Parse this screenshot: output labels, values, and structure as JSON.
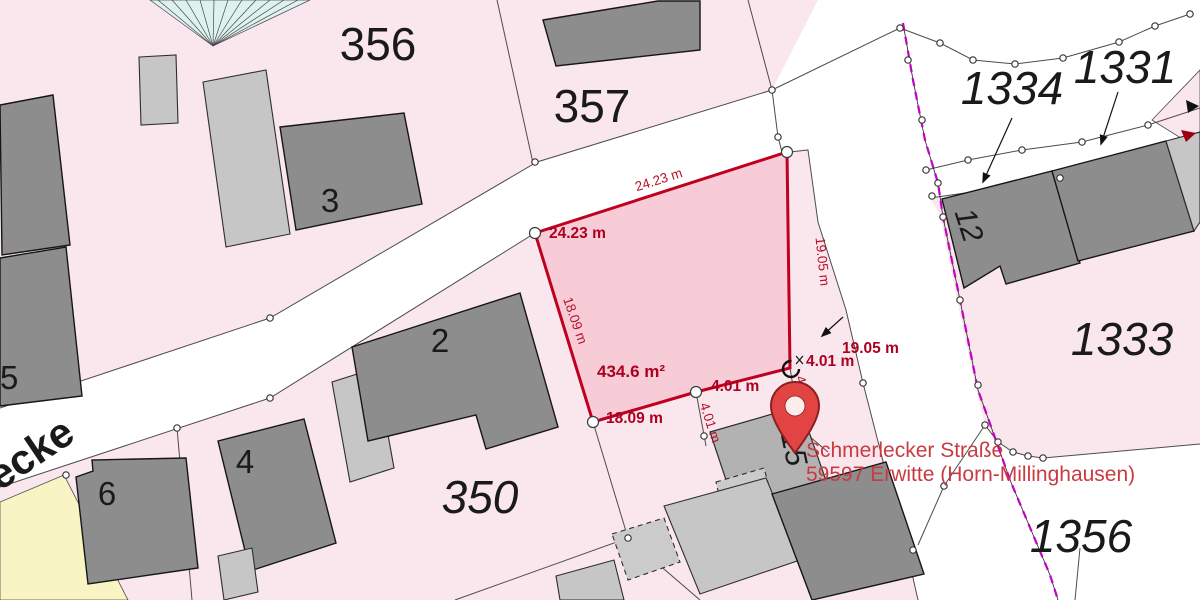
{
  "colors": {
    "parcel_pink": "#fae7ee",
    "selected_parcel_fill": "#f7ccd6",
    "selected_parcel_border": "#c00021",
    "dimension_text": "#ad0021",
    "address_text": "#c93b43",
    "boundary_magenta": "#c003c0",
    "building_dark": "#8d8d8d",
    "building_light": "#c6c6c6",
    "parcel_yellow": "#f8f4c3",
    "hatch_teal": "#ddf1ef",
    "pin_red": "#e24444"
  },
  "parcels": {
    "p356": "356",
    "p357": "357",
    "p350": "350",
    "p1334": "1334",
    "p1331": "1331",
    "p1333": "1333",
    "p1356": "1356"
  },
  "buildings": {
    "b2": "2",
    "b3": "3",
    "b4": "4",
    "b5": "5",
    "b6": "6",
    "b12": "12",
    "b15": "15"
  },
  "street": {
    "name_partial": "lecke"
  },
  "selected_parcel": {
    "area": "434.6 m²",
    "edge_top": "24.23 m",
    "edge_right": "19.05 m",
    "edge_left": "18.09 m",
    "edge_small_1": "4.01 m",
    "edge_small_2": "4.01 m",
    "label_top": "24.23 m",
    "label_right": "19.05 m",
    "label_left": "18.09 m",
    "label_small_1": "4.01 m",
    "label_small_2": "4.01 m"
  },
  "address": {
    "line1": "Schmerlecker Straße",
    "line2": "59597 Erwitte (Horn-Millinghausen)"
  }
}
